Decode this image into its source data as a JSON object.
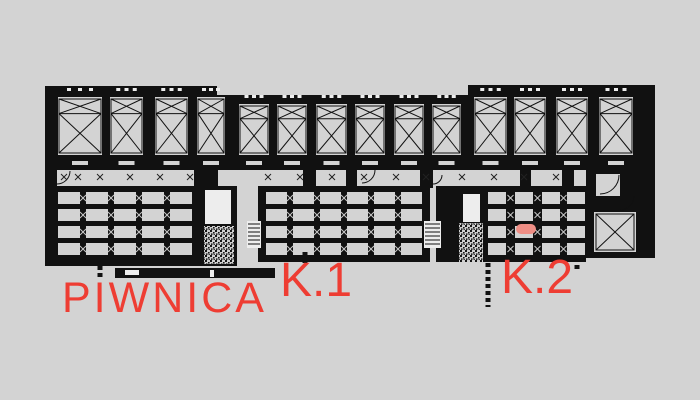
{
  "drawing": {
    "name": "basement-floor-plan",
    "colors": {
      "background": "#d3d3d3",
      "ink": "#111111",
      "cell_gray": "#d3d3d3",
      "light_white": "#ededed",
      "label_red": "#ee3d33",
      "marker_pink": "#ef8e85"
    }
  },
  "labels": {
    "piwnica": {
      "text": "PIWNICA"
    },
    "k1": {
      "text": "K.1"
    },
    "k2": {
      "text": "K.2"
    }
  },
  "marker": {
    "x": 516,
    "y": 224,
    "w": 20,
    "h": 10
  },
  "plan": {
    "top_band": {
      "segments": [
        {
          "x": 45,
          "y": 86,
          "w": 172,
          "h": 84
        },
        {
          "x": 217,
          "y": 95,
          "w": 251,
          "h": 75
        },
        {
          "x": 468,
          "y": 85,
          "w": 187,
          "h": 85
        }
      ],
      "stalls": [
        {
          "x": 58,
          "y": 97,
          "w": 44,
          "h": 58
        },
        {
          "x": 110,
          "y": 97,
          "w": 33,
          "h": 58
        },
        {
          "x": 155,
          "y": 97,
          "w": 33,
          "h": 58
        },
        {
          "x": 197,
          "y": 97,
          "w": 28,
          "h": 58
        },
        {
          "x": 239,
          "y": 104,
          "w": 30,
          "h": 51
        },
        {
          "x": 277,
          "y": 104,
          "w": 30,
          "h": 51
        },
        {
          "x": 316,
          "y": 104,
          "w": 31,
          "h": 51
        },
        {
          "x": 355,
          "y": 104,
          "w": 30,
          "h": 51
        },
        {
          "x": 394,
          "y": 104,
          "w": 30,
          "h": 51
        },
        {
          "x": 432,
          "y": 104,
          "w": 29,
          "h": 51
        },
        {
          "x": 474,
          "y": 97,
          "w": 33,
          "h": 58
        },
        {
          "x": 514,
          "y": 97,
          "w": 32,
          "h": 58
        },
        {
          "x": 556,
          "y": 97,
          "w": 32,
          "h": 58
        },
        {
          "x": 599,
          "y": 97,
          "w": 34,
          "h": 58
        }
      ]
    },
    "blocks": [
      {
        "x": 45,
        "y": 186,
        "w": 192,
        "h": 80,
        "cols": [
          58,
          86,
          114,
          142,
          170
        ],
        "colw": 22,
        "rows": [
          192,
          209,
          226,
          243
        ],
        "rowh": 12
      },
      {
        "x": 258,
        "y": 186,
        "w": 172,
        "h": 76,
        "cols": [
          266,
          293,
          320,
          347,
          374,
          401
        ],
        "colw": 21,
        "rows": [
          192,
          209,
          226,
          243
        ],
        "rowh": 12
      },
      {
        "x": 436,
        "y": 186,
        "w": 150,
        "h": 76,
        "cols": [
          488,
          515,
          542,
          567
        ],
        "colw": 18,
        "rows": [
          192,
          209,
          226,
          243
        ],
        "rowh": 12
      }
    ],
    "white_rects": [
      {
        "x": 205,
        "y": 190,
        "w": 26,
        "h": 34
      },
      {
        "x": 463,
        "y": 194,
        "w": 17,
        "h": 28
      },
      {
        "x": 620,
        "y": 173,
        "w": 12,
        "h": 12
      }
    ],
    "stipples": [
      {
        "x": 204,
        "y": 226,
        "w": 30,
        "h": 38
      },
      {
        "x": 459,
        "y": 223,
        "w": 24,
        "h": 39
      }
    ],
    "ladders": [
      {
        "x": 247,
        "y": 221,
        "w": 14,
        "h": 27
      },
      {
        "x": 424,
        "y": 221,
        "w": 17,
        "h": 27
      }
    ],
    "shaft": {
      "outer": {
        "x": 586,
        "y": 166,
        "w": 69,
        "h": 92
      },
      "room": {
        "x": 594,
        "y": 212,
        "w": 42,
        "h": 40
      },
      "upper_room": {
        "x": 596,
        "y": 174,
        "w": 24,
        "h": 22
      }
    },
    "connectors": [
      {
        "x": 45,
        "y": 168,
        "w": 12,
        "h": 20
      },
      {
        "x": 194,
        "y": 168,
        "w": 24,
        "h": 20
      },
      {
        "x": 303,
        "y": 168,
        "w": 13,
        "h": 20
      },
      {
        "x": 346,
        "y": 168,
        "w": 11,
        "h": 20
      },
      {
        "x": 420,
        "y": 168,
        "w": 13,
        "h": 20
      },
      {
        "x": 520,
        "y": 168,
        "w": 11,
        "h": 20
      },
      {
        "x": 562,
        "y": 166,
        "w": 12,
        "h": 22
      },
      {
        "x": 588,
        "y": 166,
        "w": 12,
        "h": 22
      },
      {
        "x": 640,
        "y": 168,
        "w": 15,
        "h": 44
      }
    ],
    "bottom_bars": [
      {
        "x": 115,
        "y": 268,
        "w": 160,
        "h": 10
      }
    ],
    "wall_dashes": [
      {
        "x": 125,
        "y": 270,
        "w": 14,
        "h": 5
      },
      {
        "x": 210,
        "y": 270,
        "w": 4,
        "h": 7
      }
    ],
    "stubs": [
      {
        "x": 100,
        "y": 266,
        "len": 14
      },
      {
        "x": 305,
        "y": 252,
        "len": 12
      },
      {
        "x": 488,
        "y": 263,
        "len": 44
      },
      {
        "x": 577,
        "y": 258,
        "len": 14
      }
    ],
    "arcs": [
      {
        "cx": 57,
        "cy": 171,
        "r": 13
      },
      {
        "cx": 362,
        "cy": 170,
        "r": 13
      },
      {
        "cx": 433,
        "cy": 175,
        "r": 9
      },
      {
        "cx": 600,
        "cy": 175,
        "r": 19
      },
      {
        "cx": 620,
        "cy": 196,
        "r": 14
      }
    ],
    "corridor_marks": {
      "y": 177,
      "xs": [
        64,
        78,
        100,
        130,
        160,
        190,
        268,
        300,
        332,
        364,
        396,
        426,
        462,
        494,
        524,
        556
      ]
    }
  }
}
